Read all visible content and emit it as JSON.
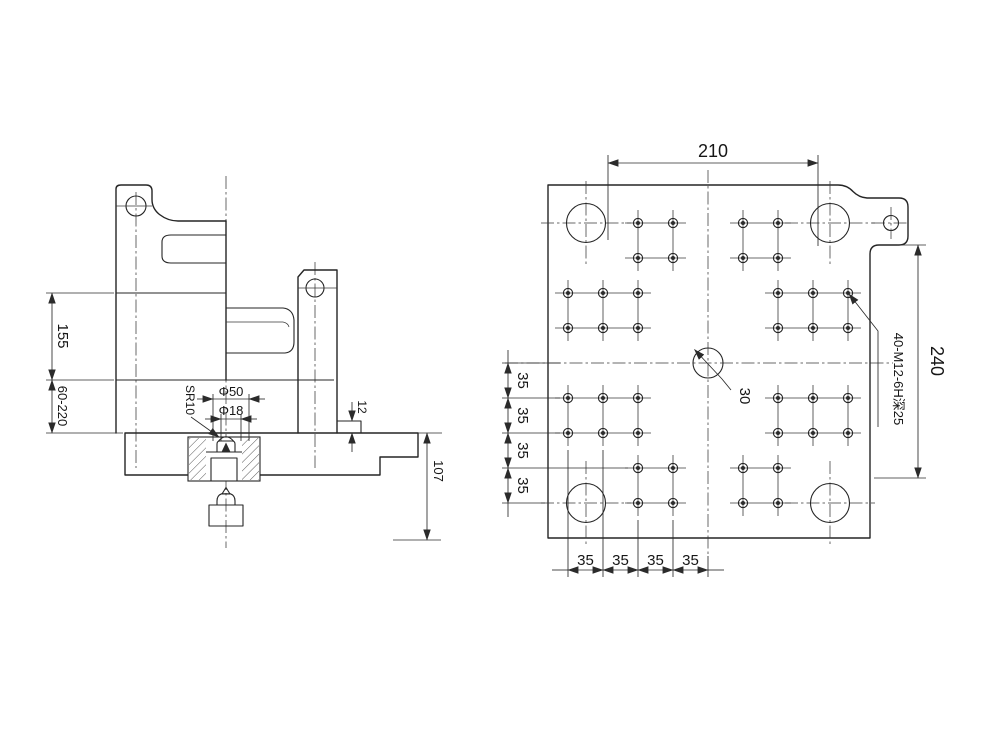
{
  "drawing_type": "engineering-drawing-two-views",
  "colors": {
    "line": "#252525",
    "background": "#ffffff"
  },
  "side_view": {
    "dim_155": "155",
    "dim_60_220": "60-220",
    "dim_d50": "Φ50",
    "dim_d18": "Φ18",
    "dim_sr10": "SR10",
    "dim_12": "12",
    "dim_107": "107"
  },
  "front_view": {
    "dim_210": "210",
    "dim_240": "240",
    "dim_30": "30",
    "hole_note": "40-M12-6H深25",
    "left_chain": [
      "35",
      "35",
      "35",
      "35"
    ],
    "bottom_chain": [
      "35",
      "35",
      "35",
      "35"
    ]
  },
  "geometry": {
    "plate": {
      "x1": 548,
      "y1": 185,
      "x2": 870,
      "y2": 538
    },
    "tie_bar_holes": [
      {
        "cx": 586,
        "cy": 223
      },
      {
        "cx": 830,
        "cy": 223
      },
      {
        "cx": 586,
        "cy": 503
      },
      {
        "cx": 830,
        "cy": 503
      }
    ],
    "tie_bar_radius": 19.5,
    "ear_hole": {
      "cx": 891,
      "cy": 223,
      "r": 7.5
    },
    "center_hole": {
      "cx": 708,
      "cy": 363,
      "r": 15
    },
    "mounting_hole": {
      "outer_r": 4.6,
      "inner_r": 2.0,
      "line_overhang": 13
    },
    "clusters": [
      {
        "cols": [
          638,
          673
        ],
        "rows": [
          223,
          258
        ]
      },
      {
        "cols": [
          743,
          778
        ],
        "rows": [
          223,
          258
        ]
      },
      {
        "cols": [
          568,
          603,
          638
        ],
        "rows": [
          293,
          328
        ]
      },
      {
        "cols": [
          778,
          813,
          848
        ],
        "rows": [
          293,
          328
        ]
      },
      {
        "cols": [
          568,
          603,
          638
        ],
        "rows": [
          398,
          433
        ]
      },
      {
        "cols": [
          778,
          813,
          848
        ],
        "rows": [
          398,
          433
        ]
      },
      {
        "cols": [
          638,
          673
        ],
        "rows": [
          468,
          503
        ]
      },
      {
        "cols": [
          743,
          778
        ],
        "rows": [
          468,
          503
        ]
      }
    ]
  }
}
